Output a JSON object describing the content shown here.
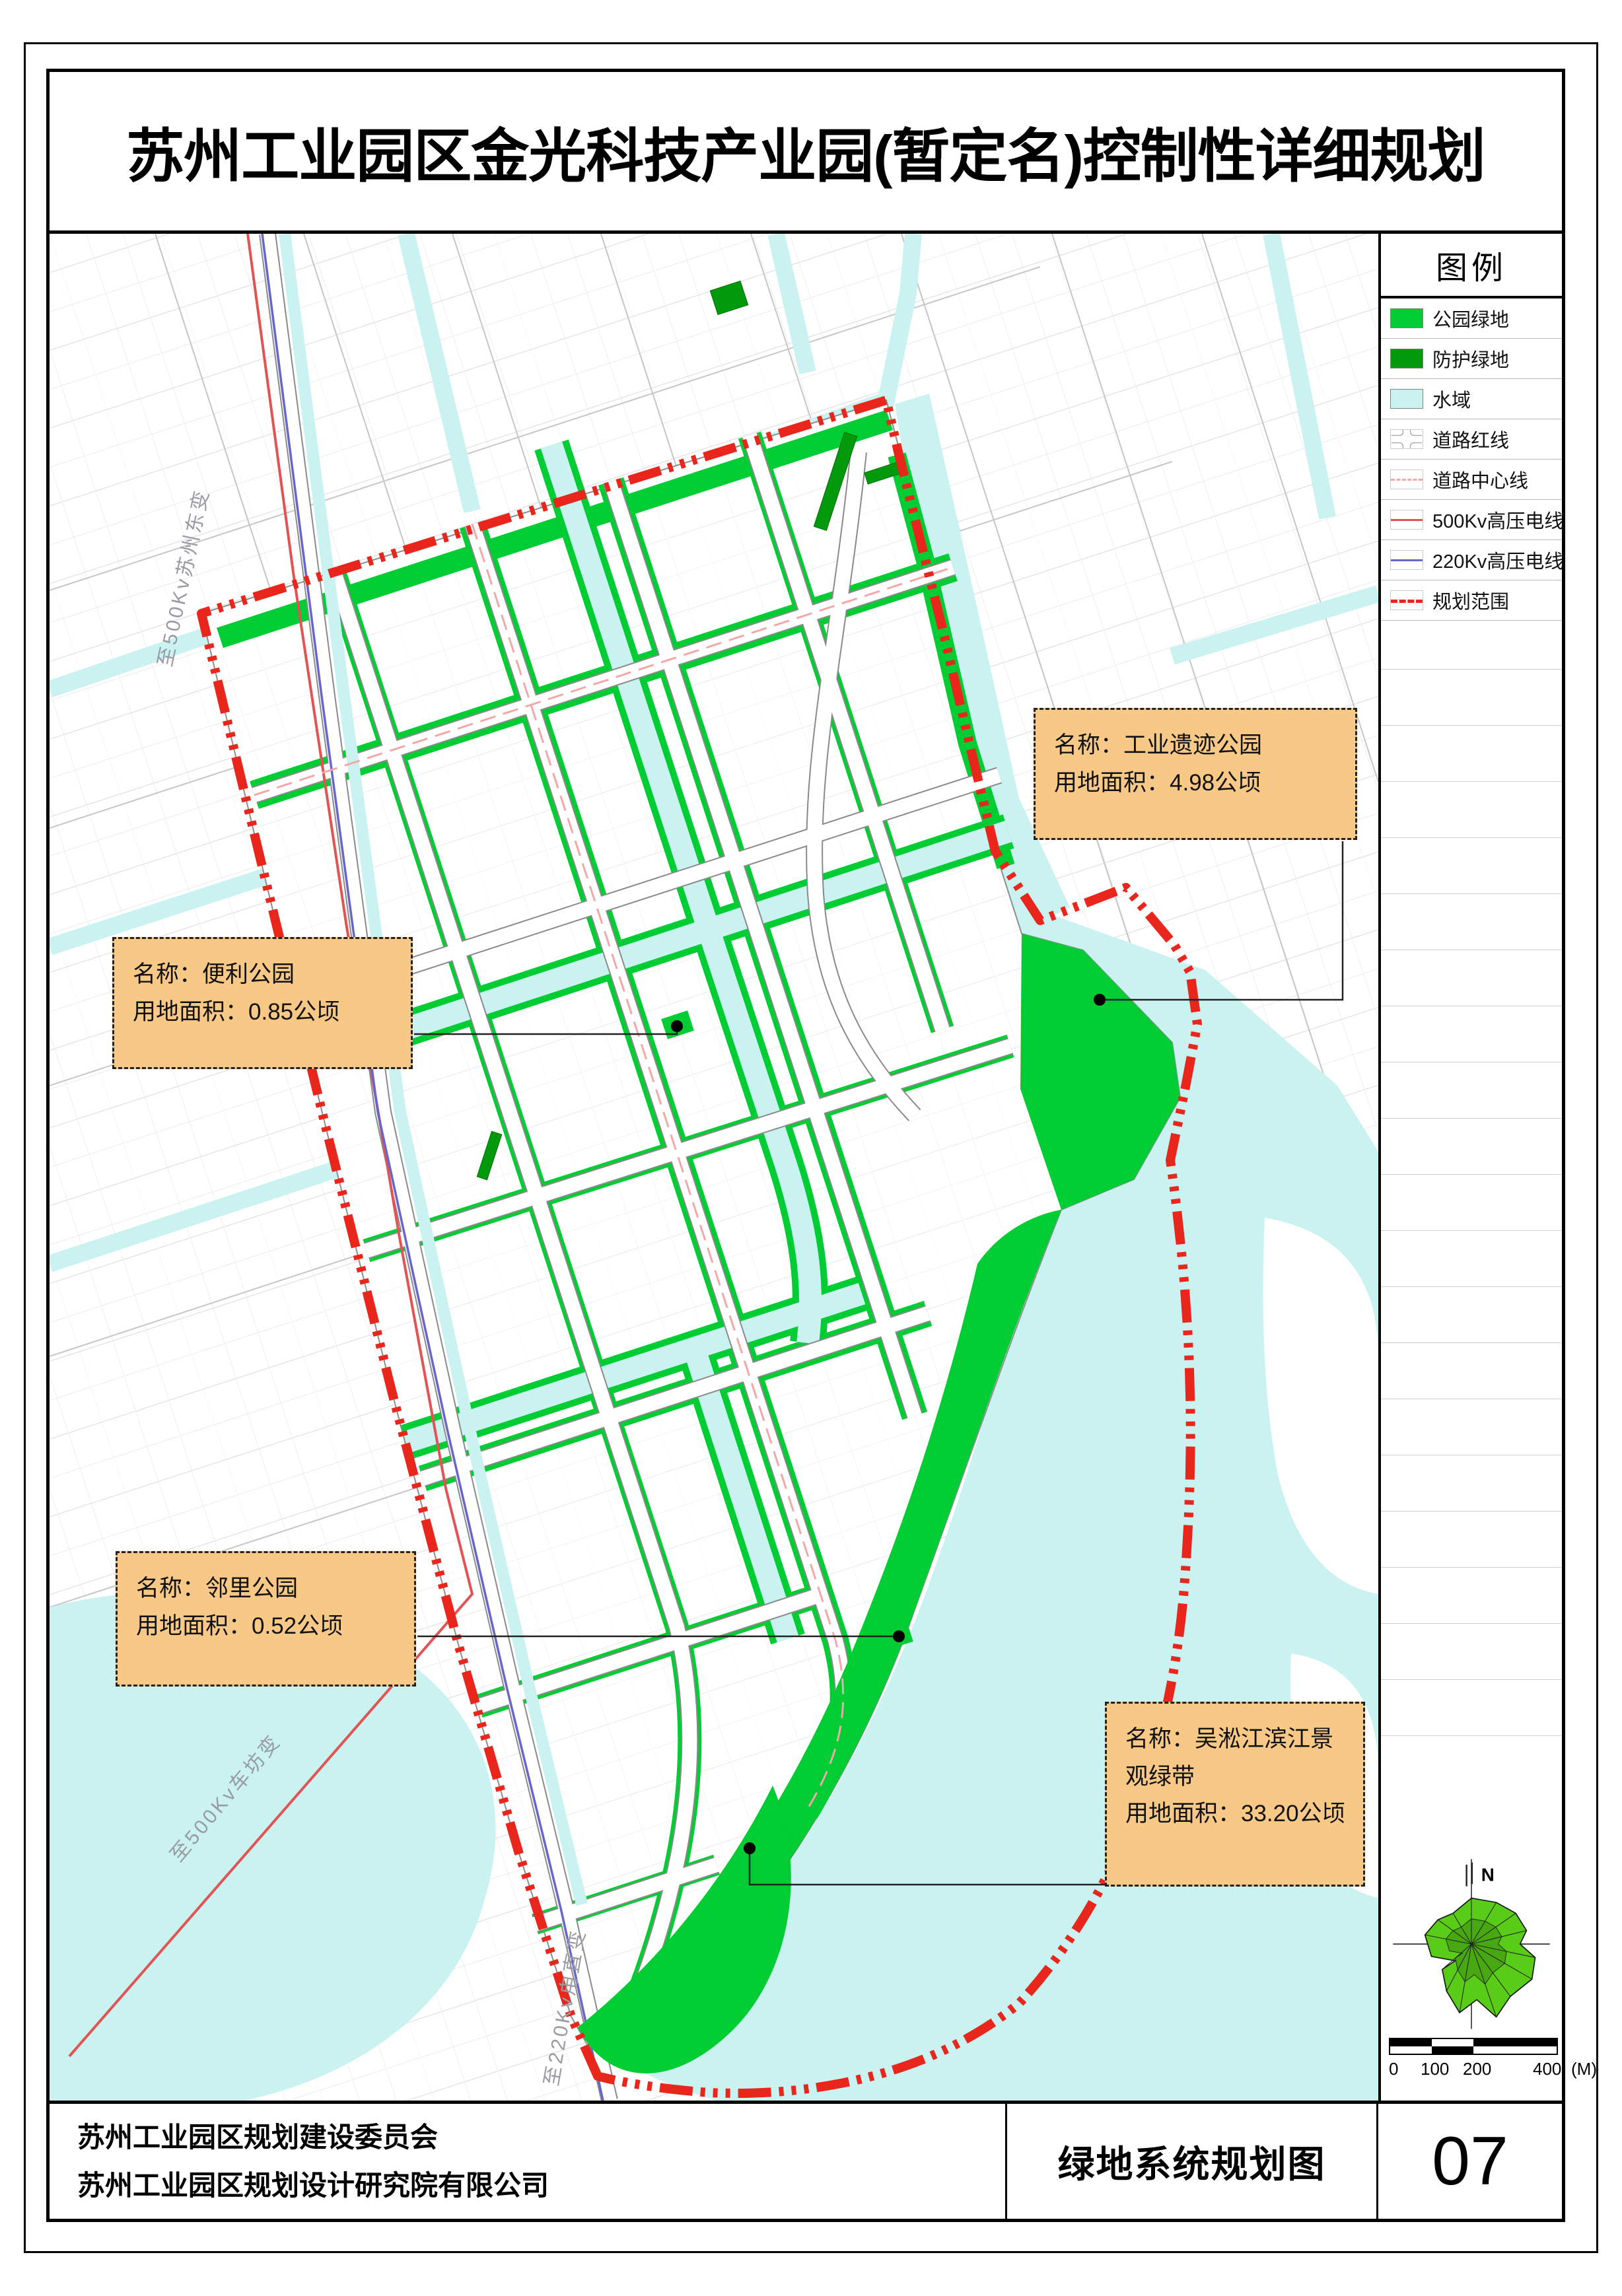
{
  "header": {
    "title": "苏州工业园区金光科技产业园(暂定名)控制性详细规划"
  },
  "legend": {
    "title": "图例",
    "items": [
      {
        "label": "公园绿地",
        "type": "fill",
        "color": "#00CC33"
      },
      {
        "label": "防护绿地",
        "type": "fill",
        "color": "#009A0C"
      },
      {
        "label": "水域",
        "type": "fill",
        "color": "#C9F2F0"
      },
      {
        "label": "道路红线",
        "type": "road",
        "color": "#AAAAAA"
      },
      {
        "label": "道路中心线",
        "type": "dash",
        "color": "#F2A8A8"
      },
      {
        "label": "500Kv高压电线",
        "type": "solid",
        "color": "#E25353"
      },
      {
        "label": "220Kv高压电线",
        "type": "solid",
        "color": "#6666CC"
      },
      {
        "label": "规划范围",
        "type": "dash-bold",
        "color": "#E8261C"
      }
    ]
  },
  "callouts": {
    "industrial": {
      "name_line": "名称：工业遗迹公园",
      "area_line": "用地面积：4.98公顷"
    },
    "convenience": {
      "name_line": "名称：便利公园",
      "area_line": "用地面积：0.85公顷"
    },
    "neighborhood": {
      "name_line": "名称：邻里公园",
      "area_line": "用地面积：0.52公顷"
    },
    "riverfront": {
      "name_line": "名称：吴淞江滨江景观绿带",
      "area_line": "用地面积：33.20公顷"
    }
  },
  "map_labels": {
    "to_500kv_suzhou_east": "至500Kv苏州东变",
    "to_500kv_chefang": "至500Kv车坊变",
    "to_220kv_luzhi": "至220Kv甪直变"
  },
  "compass": {
    "north": "N"
  },
  "scalebar": {
    "tick0": "0",
    "tick1": "100",
    "tick2": "200",
    "tick3": "400",
    "unit": "(M)"
  },
  "footer": {
    "org1": "苏州工业园区规划建设委员会",
    "org2": "苏州工业园区规划设计研究院有限公司",
    "drawing_title": "绿地系统规划图",
    "sheet_no": "07"
  },
  "colors": {
    "park": "#00CC33",
    "protect": "#009A0C",
    "water": "#C9F2F0",
    "bred": "#E8261C",
    "l500": "#E25353",
    "l220": "#6666CC",
    "cline": "#F2A8A8",
    "callout_bg": "#F7C886"
  }
}
